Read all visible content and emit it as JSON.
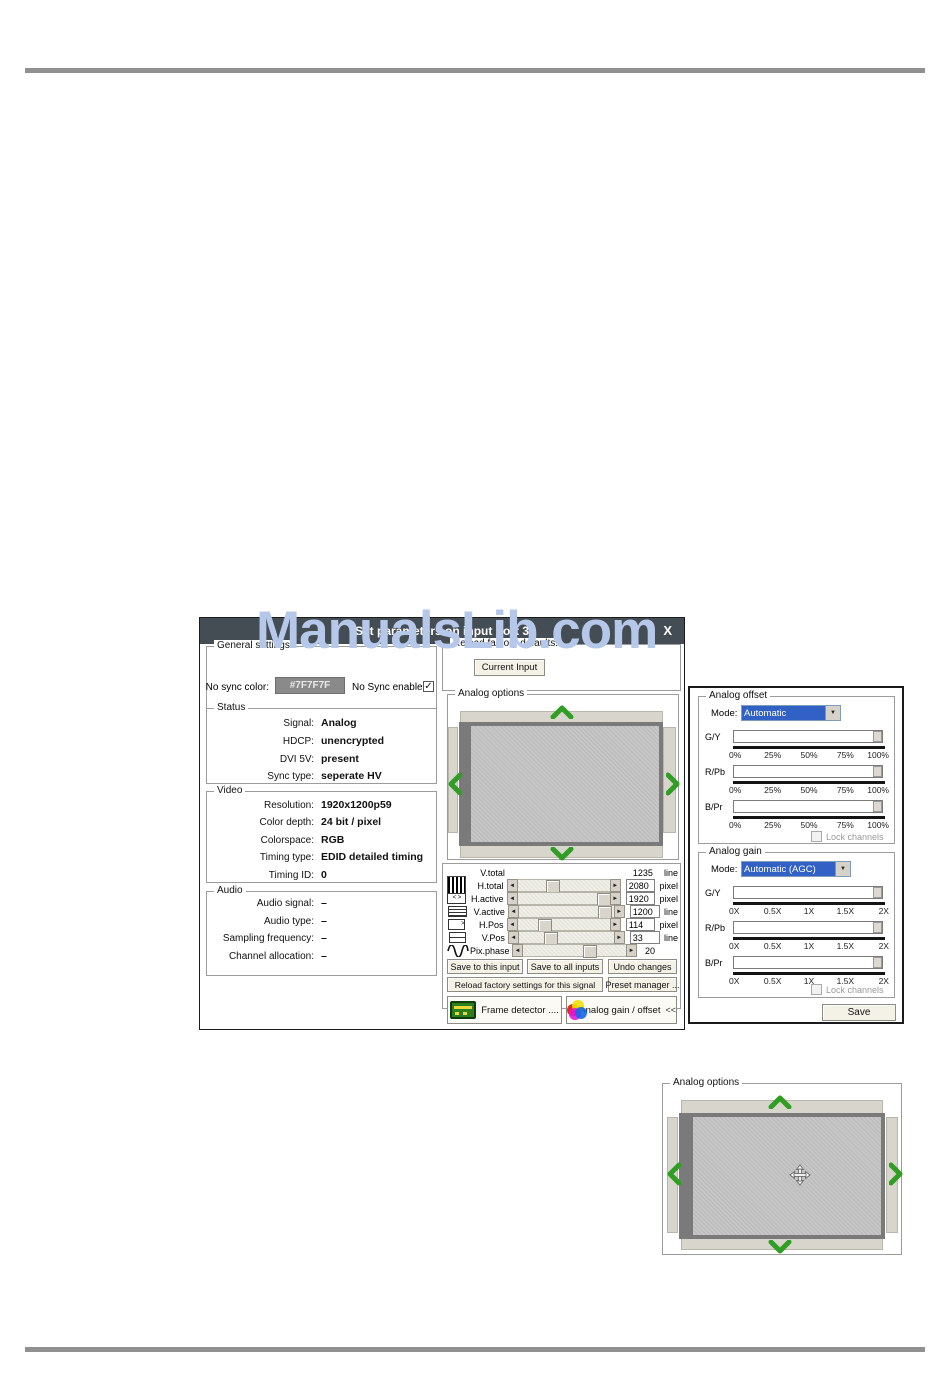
{
  "page": {
    "watermark": "ManualsLib.com",
    "glyphs": {
      "left": "◄",
      "right": "►",
      "down": "▼",
      "check": "✓",
      "close": "X"
    },
    "colors": {
      "watermark": "#b6c8ea",
      "title_bar": "#454d54",
      "arrow_green": "#2f9e23",
      "no_sync_swatch": "#8a8a8a"
    }
  },
  "dialog": {
    "title": "Set parameters on input port 3",
    "general": {
      "label": "General settings",
      "no_sync_color_label": "No sync color:",
      "no_sync_color_value": "#7F7F7F",
      "no_sync_enable_label": "No Sync enable"
    },
    "status": {
      "label": "Status",
      "rows": [
        {
          "label": "Signal:",
          "value": "Analog"
        },
        {
          "label": "HDCP:",
          "value": "unencrypted"
        },
        {
          "label": "DVI 5V:",
          "value": "present"
        },
        {
          "label": "Sync type:",
          "value": "seperate HV"
        }
      ]
    },
    "video": {
      "label": "Video",
      "rows": [
        {
          "label": "Resolution:",
          "value": "1920x1200p59"
        },
        {
          "label": "Color depth:",
          "value": "24 bit / pixel"
        },
        {
          "label": "Colorspace:",
          "value": "RGB"
        },
        {
          "label": "Timing type:",
          "value": "EDID detailed timing"
        },
        {
          "label": "Timing ID:",
          "value": "0"
        }
      ]
    },
    "audio": {
      "label": "Audio",
      "rows": [
        {
          "label": "Audio signal:",
          "value": "–"
        },
        {
          "label": "Audio type:",
          "value": "–"
        },
        {
          "label": "Sampling frequency:",
          "value": "–"
        },
        {
          "label": "Channel allocation:",
          "value": "–"
        }
      ]
    },
    "reload": {
      "label": "Reload factory defaults:",
      "current_input_button": "Current Input"
    },
    "analog_options": {
      "label": "Analog options"
    },
    "timing": {
      "rows": [
        {
          "label": "V.total",
          "value": "1235",
          "unit": "line"
        },
        {
          "label": "H.total",
          "value": "2080",
          "unit": "pixel"
        },
        {
          "label": "H.active",
          "value": "1920",
          "unit": "pixel"
        },
        {
          "label": "V.active",
          "value": "1200",
          "unit": "line"
        },
        {
          "label": "H.Pos",
          "value": "114",
          "unit": "pixel"
        },
        {
          "label": "V.Pos",
          "value": "33",
          "unit": "line"
        },
        {
          "label": "Pix.phase",
          "value": "20",
          "unit": ""
        }
      ]
    },
    "buttons": {
      "save_this": "Save to this input",
      "save_all": "Save to all inputs",
      "undo": "Undo changes",
      "reload_factory": "Reload factory settings for this signal",
      "preset_manager": "Preset manager ...",
      "frame_detector": "Frame detector ....",
      "analog_gain_offset": "Analog gain / offset",
      "collapse_glyph": "<<"
    }
  },
  "gain_panel": {
    "offset": {
      "label": "Analog offset",
      "mode_label": "Mode:",
      "mode_value": "Automatic",
      "channels": [
        "G/Y",
        "R/Pb",
        "B/Pr"
      ],
      "scale": [
        "0%",
        "25%",
        "50%",
        "75%",
        "100%"
      ],
      "lock_label": "Lock channels"
    },
    "gain": {
      "label": "Analog gain",
      "mode_label": "Mode:",
      "mode_value": "Automatic (AGC)",
      "channels": [
        "G/Y",
        "R/Pb",
        "B/Pr"
      ],
      "scale": [
        "0X",
        "0.5X",
        "1X",
        "1.5X",
        "2X"
      ],
      "lock_label": "Lock channels"
    },
    "save_button": "Save"
  },
  "bottom_panel": {
    "label": "Analog options"
  }
}
